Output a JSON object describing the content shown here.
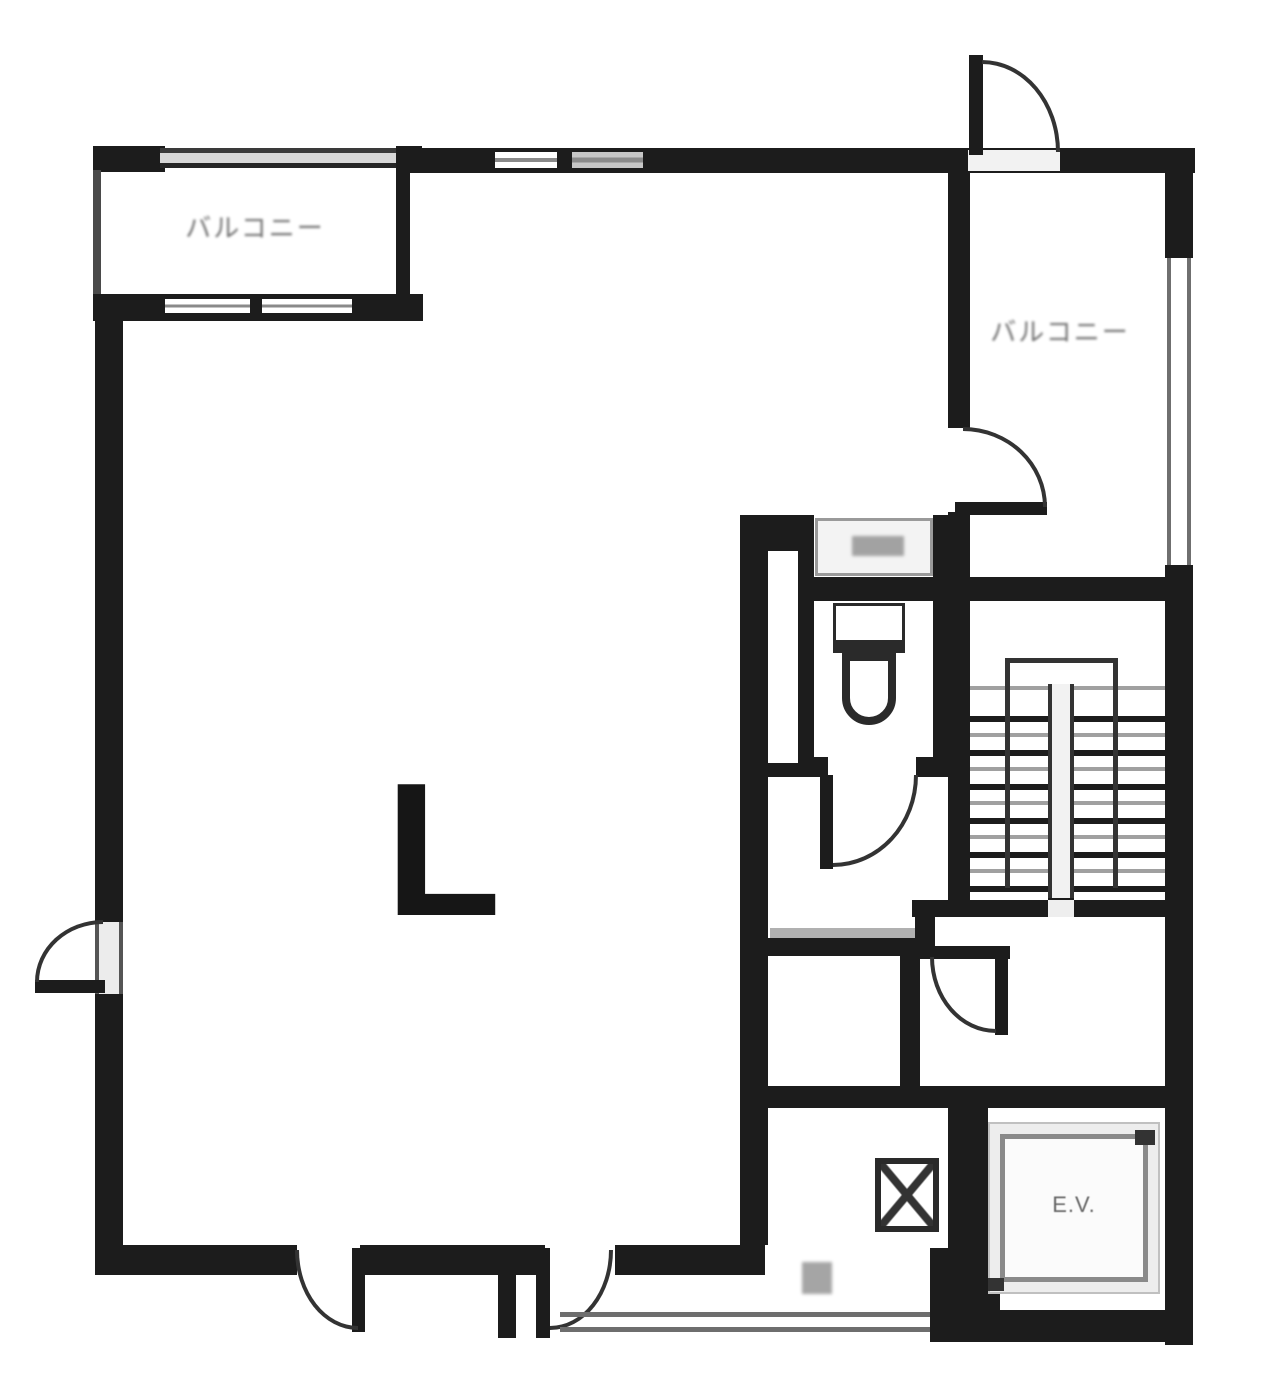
{
  "plan": {
    "labels": {
      "balcony_top_left": "バルコニー",
      "balcony_right": "バルコニー",
      "living_room": "L",
      "elevator": "E.V."
    },
    "colors": {
      "wall": "#1c1c1c",
      "rail_gray": "#9b9b9b",
      "background": "#ffffff"
    }
  }
}
